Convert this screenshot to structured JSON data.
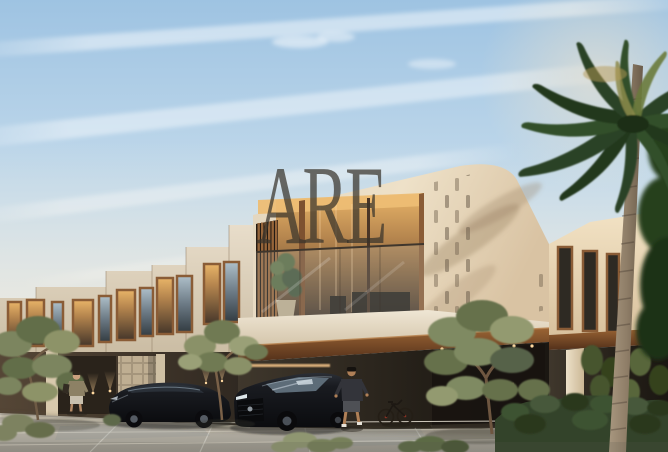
{
  "watermark": {
    "text": "ARE",
    "color": "#38332b",
    "opacity": 0.72
  },
  "scene": {
    "description": "Sunset architectural rendering of modern two-storey townhouses with warm-lit windows, central balcony, perforated facade, stone driveway, two black cars, two pedestrians, bicycles, olive trees and a tall palm tree",
    "objects": [
      "sky-with-contrails",
      "townhouse-row",
      "main-facade",
      "balcony",
      "louver-screen",
      "perforated-panel",
      "right-wing",
      "stone-driveway",
      "black-sedan",
      "black-suv",
      "pedestrian-left",
      "pedestrian-right",
      "bicycle",
      "olive-tree-left",
      "olive-tree-center",
      "olive-tree-right",
      "hedge",
      "palm-tree",
      "hanging-plants",
      "wall-uplights"
    ],
    "people_count": 2,
    "car_count": 2
  },
  "palette": {
    "sky_top": "#9ec3e2",
    "sky_horizon": "#f0e9da",
    "wall_light": "#ecdfc6",
    "wall_shadow": "#bcab92",
    "wood_accent": "#96653a",
    "window_glow": "#e8b468",
    "recess_dark": "#241f18",
    "pavement": "#b0aba0",
    "foliage_olive": "#7d8663",
    "foliage_palm": "#2d4426",
    "car_black": "#14151a",
    "watermark_color": "#38332b"
  }
}
